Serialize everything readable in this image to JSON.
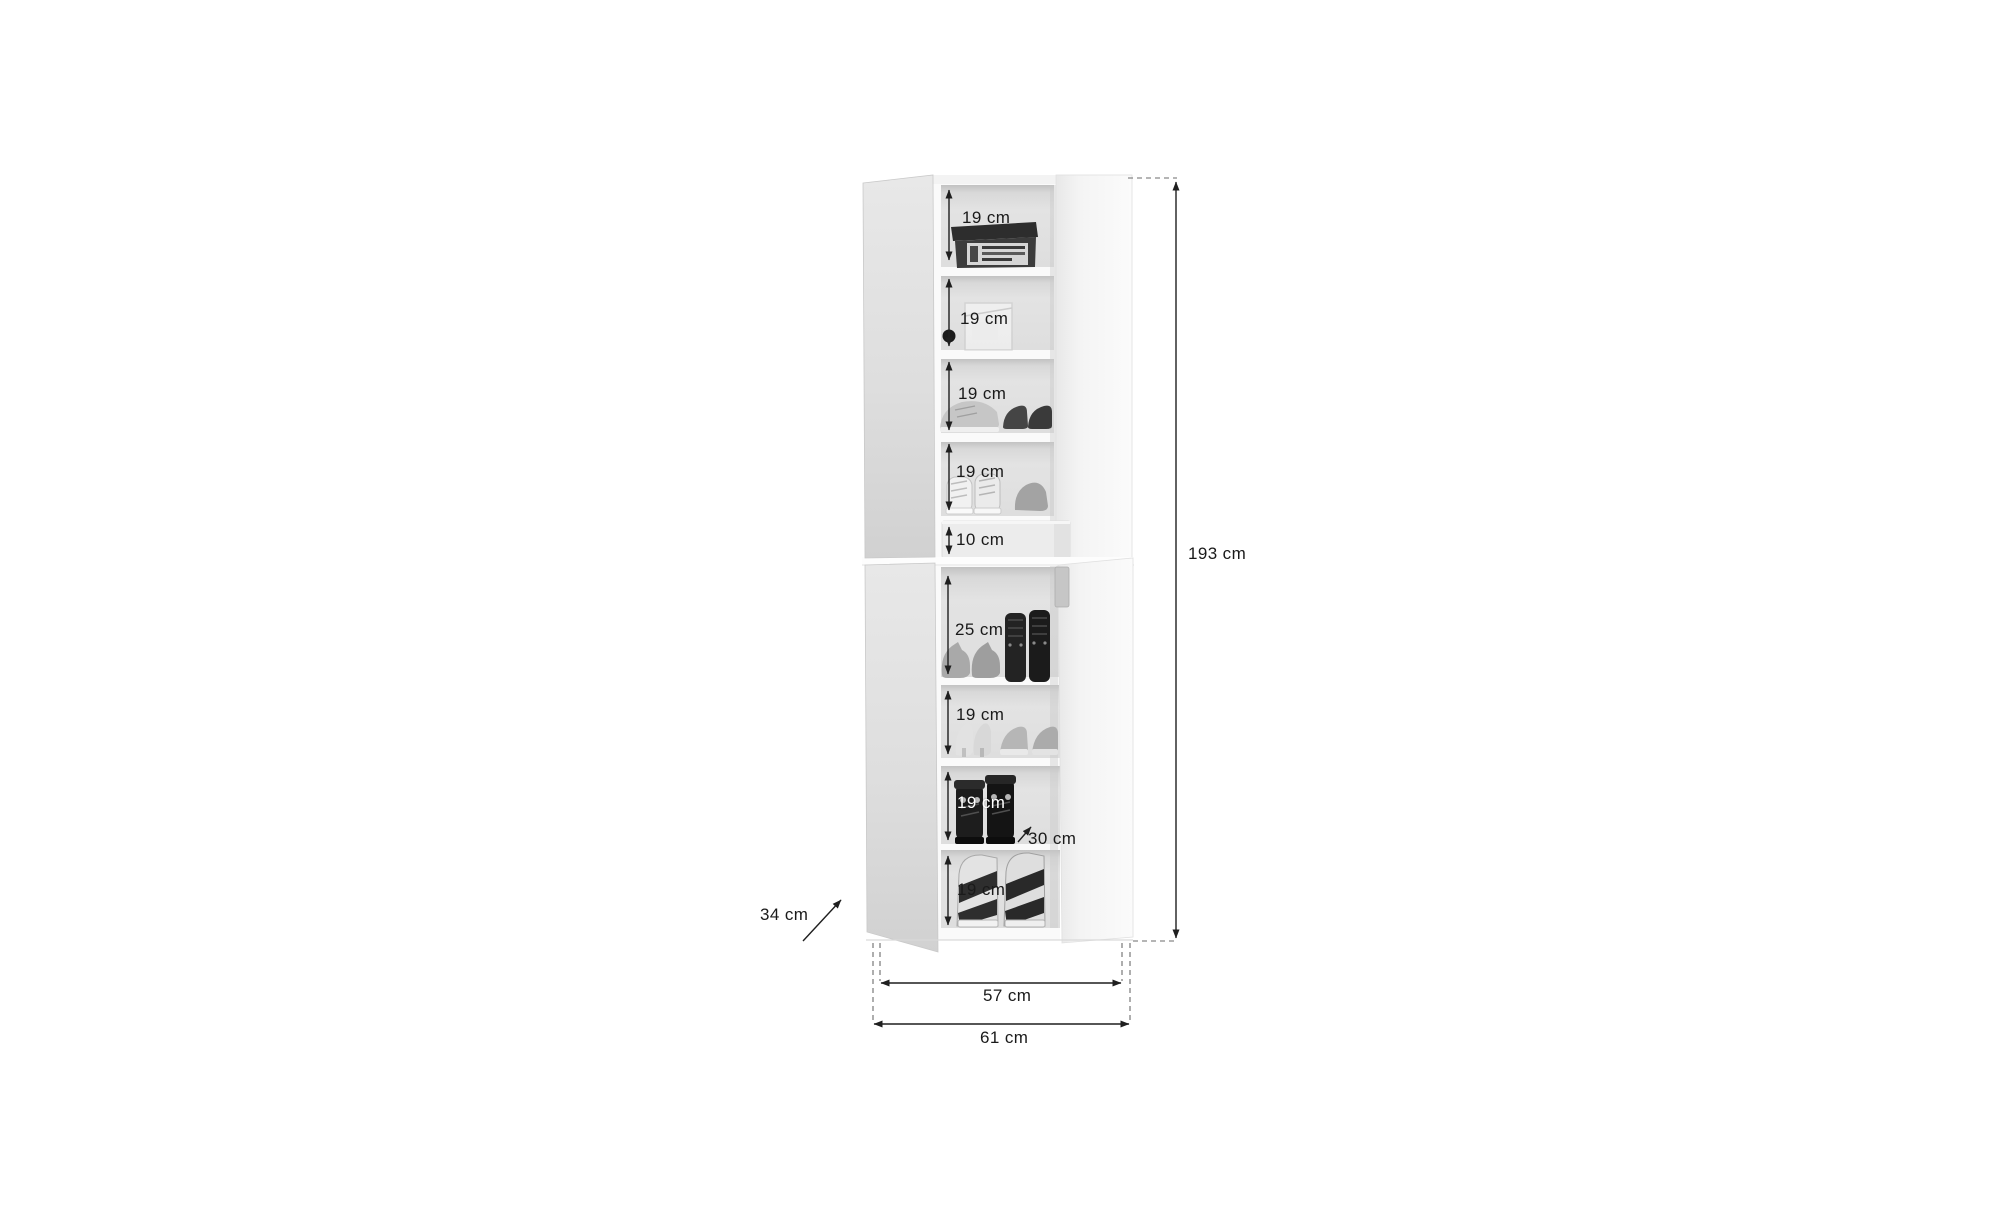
{
  "diagram": {
    "product": "shoe-cabinet-dimension-drawing",
    "colors": {
      "background": "#ffffff",
      "dimension_line": "#1f1f1f",
      "dashed_line": "#6b6b6b",
      "label_text": "#1a1a1a",
      "label_text_light": "#ffffff",
      "door_gray": "#dedede",
      "door_white": "#f6f6f6",
      "interior_gray": "#e0e0e0"
    },
    "compartments": [
      {
        "label": "19 cm",
        "content": "shoe-box"
      },
      {
        "label": "19 cm",
        "content": "clear-storage-box"
      },
      {
        "label": "19 cm",
        "content": "sneakers-and-loafers"
      },
      {
        "label": "19 cm",
        "content": "high-top-sneakers"
      },
      {
        "label": "10 cm",
        "content": "drawer"
      },
      {
        "label": "25 cm",
        "content": "flats-and-lace-up-boots"
      },
      {
        "label": "19 cm",
        "content": "heels-and-sneakers"
      },
      {
        "label": "19 cm",
        "content": "ankle-boots"
      },
      {
        "label": "19 cm",
        "content": "platform-sandals"
      }
    ],
    "dimensions": {
      "total_height": "193 cm",
      "inner_width": "57 cm",
      "total_width": "61 cm",
      "depth": "34 cm",
      "shelf_depth": "30 cm"
    }
  }
}
